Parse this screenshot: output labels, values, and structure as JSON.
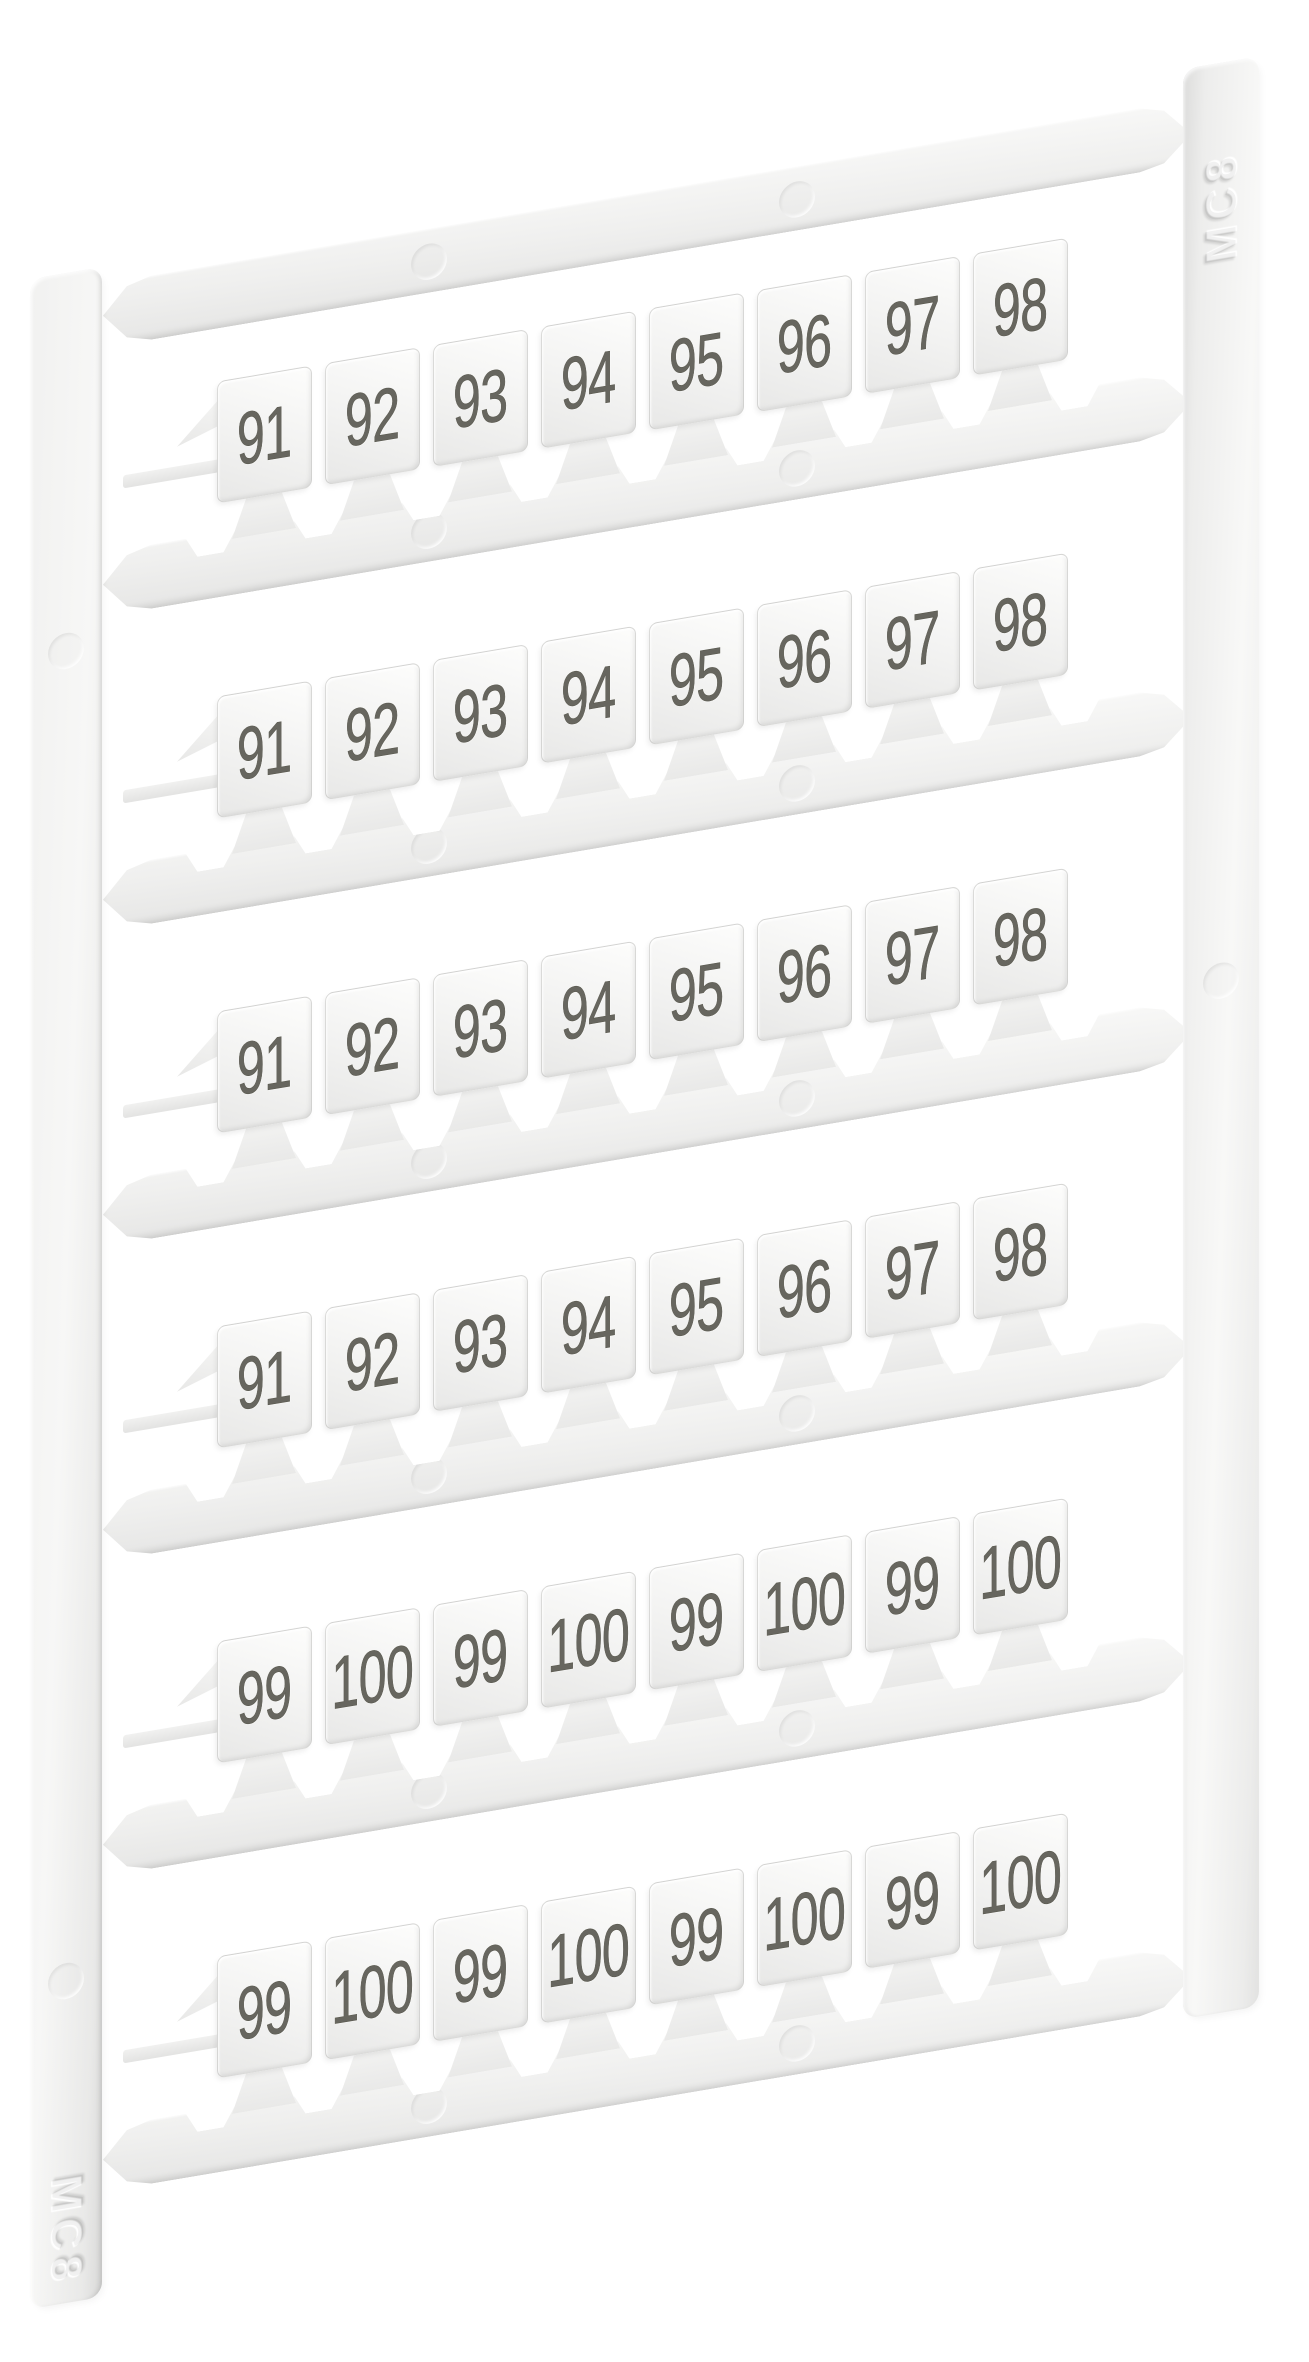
{
  "sheet": {
    "markings": {
      "left_rail": "MC8",
      "right_rail": "MC8"
    },
    "rows": [
      {
        "labels": [
          "91",
          "92",
          "93",
          "94",
          "95",
          "96",
          "97",
          "98"
        ]
      },
      {
        "labels": [
          "91",
          "92",
          "93",
          "94",
          "95",
          "96",
          "97",
          "98"
        ]
      },
      {
        "labels": [
          "91",
          "92",
          "93",
          "94",
          "95",
          "96",
          "97",
          "98"
        ]
      },
      {
        "labels": [
          "91",
          "92",
          "93",
          "94",
          "95",
          "96",
          "97",
          "98"
        ]
      },
      {
        "labels": [
          "99",
          "100",
          "99",
          "100",
          "99",
          "100",
          "99",
          "100"
        ]
      },
      {
        "labels": [
          "99",
          "100",
          "99",
          "100",
          "99",
          "100",
          "99",
          "100"
        ]
      }
    ],
    "colors": {
      "background": "#ffffff",
      "plastic": "#f2f2f1",
      "plastic_shadow": "#dcdcdb",
      "digit": "#67665f"
    }
  }
}
